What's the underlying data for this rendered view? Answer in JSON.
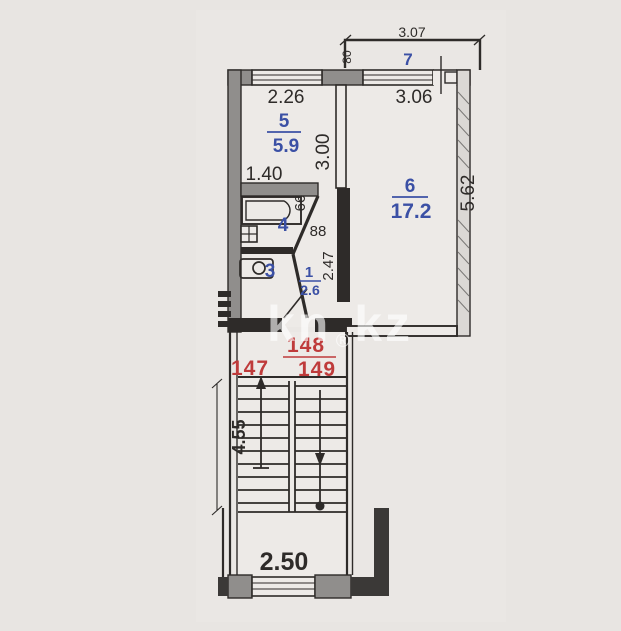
{
  "watermark": {
    "left": "kn",
    "mark": "®",
    "right": "kz"
  },
  "balcony": {
    "num": "7",
    "width": "3.07",
    "depth": "80"
  },
  "kitchen": {
    "num": "5",
    "area": "5.9",
    "width": "2.26",
    "depth": "3.00",
    "inner_width": "1.40"
  },
  "living": {
    "num": "6",
    "area": "17.2",
    "width": "3.06",
    "depth": "5.62"
  },
  "bath": {
    "num": "4"
  },
  "wc": {
    "num": "3"
  },
  "hall": {
    "num": "1",
    "area": "2.6",
    "niche_width": "66",
    "niche_depth": "88",
    "length": "2.47"
  },
  "stairs": {
    "length": "4.55"
  },
  "entry": {
    "width": "2.50"
  },
  "units": {
    "left": "147",
    "center": "148",
    "right": "149"
  },
  "colors": {
    "line": "#2e2b29",
    "wall_fill": "#908e8c",
    "room_blue": "#3b50a5",
    "unit_red": "#bf3b3b",
    "paper": "#edeae7",
    "background": "#e8e5e2"
  }
}
